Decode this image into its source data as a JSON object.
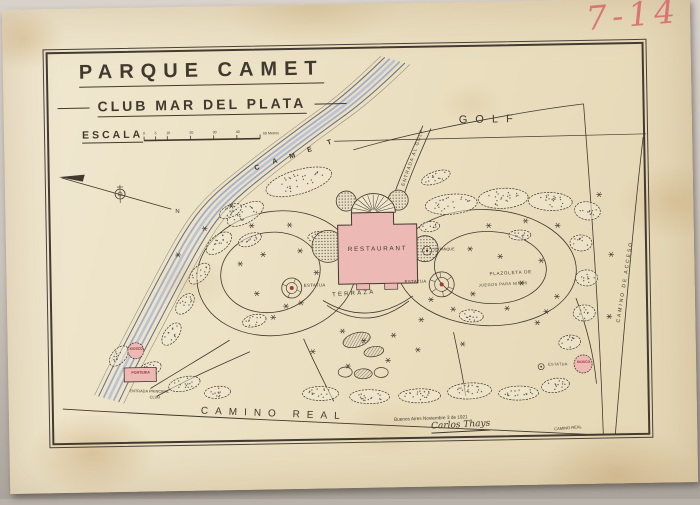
{
  "note_code": "7-14",
  "title_block": {
    "title": "PARQUE CAMET",
    "subtitle": "CLUB MAR DEL PLATA",
    "scale_label": "ESCALA",
    "scale_ticks": [
      "0",
      "5",
      "10",
      "20",
      "30",
      "40"
    ],
    "scale_end_label": "50 Metros"
  },
  "compass": {
    "label": "N"
  },
  "map_labels": {
    "golf": "GOLF",
    "entrada_golf": "ENTRADA AL GOLF",
    "river_name": "CAMET",
    "restaurant": "RESTAURANT",
    "terraza": "TERRAZA",
    "estatua_left": "ESTATUA",
    "estatua_right": "ESTATUA",
    "estanque": "ESTANQUE",
    "plazoleta_line1": "PLAZOLETA DE",
    "plazoleta_line2": "JUEGOS PARA NIÑOS",
    "kiosco_left": "KIOSCO",
    "porteria": "PORTERIA",
    "entrada_line1": "ENTRADA PRINCIPAL",
    "entrada_line2": "CLUB",
    "camino_real": "CAMINO REAL",
    "camino_acceso": "CAMINO DE ACCESO",
    "estatua_bottom_right": "ESTATUA",
    "kiosco_right": "KIOSCO",
    "camino_bottom_right": "CAMINO REAL"
  },
  "signature": {
    "place_date": "Buenos Aires Noviembre 3 de 1921",
    "author": "Carlos Thays"
  },
  "colors": {
    "paper": "#ece2c6",
    "ink": "#42392e",
    "building_pink": "#ecb9b4",
    "river_blue": "#9aa5c4",
    "red_annotation": "#d8666c"
  }
}
